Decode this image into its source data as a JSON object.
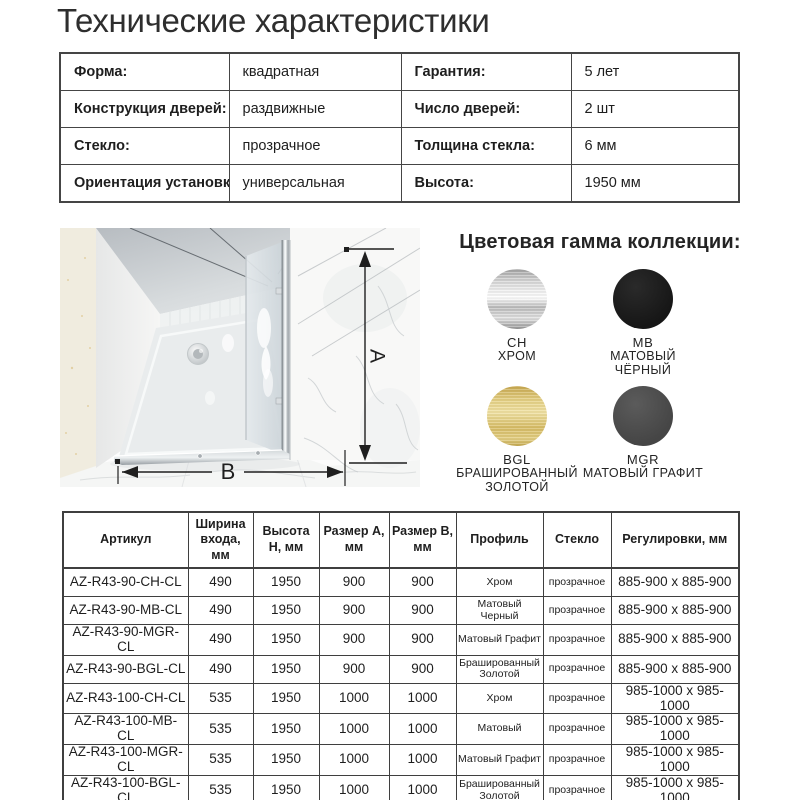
{
  "page": {
    "title": "Технические характеристики"
  },
  "spec_table": {
    "rows": [
      [
        "Форма:",
        "квадратная",
        "Гарантия:",
        "5 лет"
      ],
      [
        "Конструкция дверей:",
        "раздвижные",
        "Число дверей:",
        "2 шт"
      ],
      [
        "Стекло:",
        "прозрачное",
        "Толщина стекла:",
        "6 мм"
      ],
      [
        "Ориентация установки:",
        "универсальная",
        "Высота:",
        "1950 мм"
      ]
    ]
  },
  "diagram": {
    "label_a": "A",
    "label_b": "B"
  },
  "colors": {
    "title": "Цветовая гамма коллекции:",
    "swatches": [
      {
        "code": "CH",
        "name": "ХРОМ",
        "type": "chrome",
        "hex": "#c9c9c9"
      },
      {
        "code": "MB",
        "name": "МАТОВЫЙ ЧЁРНЫЙ",
        "type": "black",
        "hex": "#1b1b1b"
      },
      {
        "code": "BGL",
        "name": "БРАШИРОВАННЫЙ ЗОЛОТОЙ",
        "type": "gold",
        "hex": "#d9c26c"
      },
      {
        "code": "MGR",
        "name": "МАТОВЫЙ ГРАФИТ",
        "type": "graphite",
        "hex": "#4f4f4f"
      }
    ]
  },
  "product_table": {
    "headers": [
      "Артикул",
      "Ширина входа, мм",
      "Высота H, мм",
      "Размер A, мм",
      "Размер B, мм",
      "Профиль",
      "Стекло",
      "Регулировки, мм"
    ],
    "rows": [
      [
        "AZ-R43-90-CH-CL",
        "490",
        "1950",
        "900",
        "900",
        "Хром",
        "прозрачное",
        "885-900 x 885-900"
      ],
      [
        "AZ-R43-90-MB-CL",
        "490",
        "1950",
        "900",
        "900",
        "Матовый Черный",
        "прозрачное",
        "885-900 x 885-900"
      ],
      [
        "AZ-R43-90-MGR-CL",
        "490",
        "1950",
        "900",
        "900",
        "Матовый Графит",
        "прозрачное",
        "885-900 x 885-900"
      ],
      [
        "AZ-R43-90-BGL-CL",
        "490",
        "1950",
        "900",
        "900",
        "Брашированный Золотой",
        "прозрачное",
        "885-900 x 885-900"
      ],
      [
        "AZ-R43-100-CH-CL",
        "535",
        "1950",
        "1000",
        "1000",
        "Хром",
        "прозрачное",
        "985-1000 x 985-1000"
      ],
      [
        "AZ-R43-100-MB-CL",
        "535",
        "1950",
        "1000",
        "1000",
        "Матовый",
        "прозрачное",
        "985-1000 x 985-1000"
      ],
      [
        "AZ-R43-100-MGR-CL",
        "535",
        "1950",
        "1000",
        "1000",
        "Матовый Графит",
        "прозрачное",
        "985-1000 x 985-1000"
      ],
      [
        "AZ-R43-100-BGL-CL",
        "535",
        "1950",
        "1000",
        "1000",
        "Брашированный Золотой",
        "прозрачное",
        "985-1000 x 985-1000"
      ]
    ]
  }
}
